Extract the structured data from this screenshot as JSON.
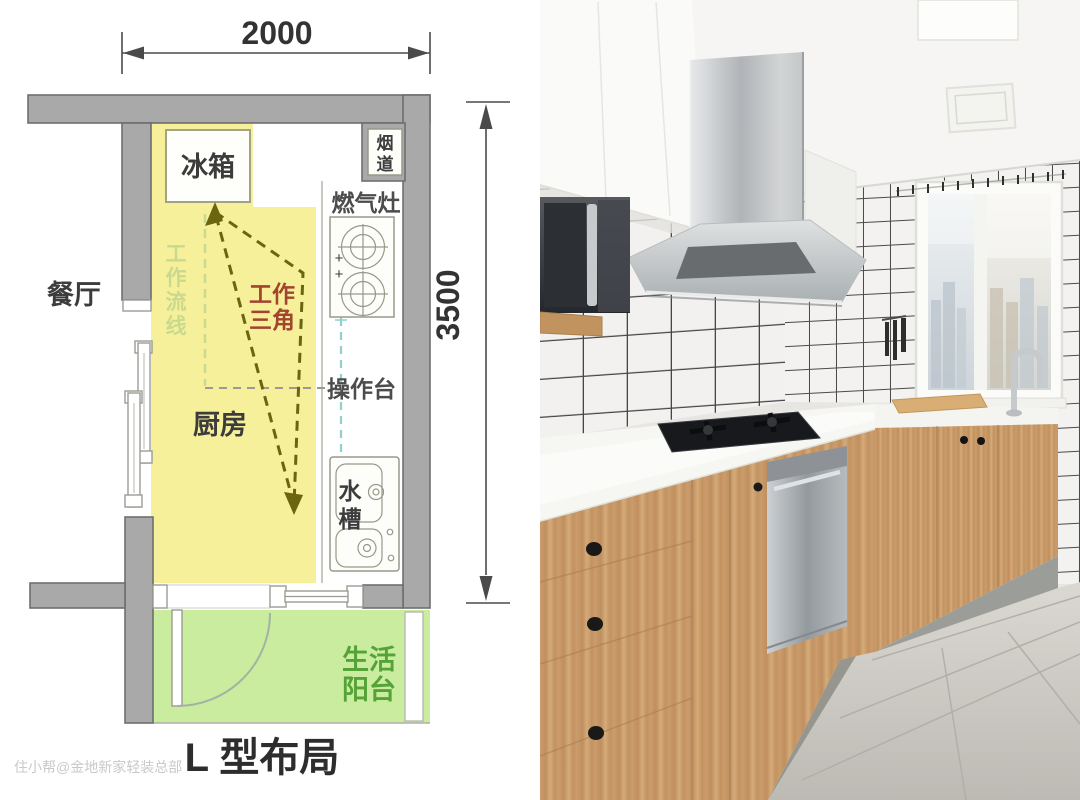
{
  "plan": {
    "dims": {
      "width": "2000",
      "height": "3500"
    },
    "labels": {
      "dining": "餐厅",
      "kitchen": "厨房",
      "fridge": "冰箱",
      "flue": [
        "烟",
        "道"
      ],
      "stove": "燃气灶",
      "counter": "操作台",
      "sink": [
        "水",
        "槽"
      ],
      "balcony": [
        "生活",
        "阳台"
      ],
      "triangle": [
        "工作",
        "三角"
      ],
      "flow": [
        "工",
        "作",
        "流",
        "线"
      ],
      "plus": [
        "+",
        "+"
      ]
    },
    "caption": "L 型布局",
    "watermark": "住小帮@金地新家轻装总部"
  },
  "colors": {
    "kitchen_fill": "#f7f09b",
    "balcony_fill": "#c9ec9f",
    "wall_fill": "#a9a9a9",
    "wall_stroke": "#6f6f6f",
    "fixture_stroke": "#98988a",
    "triangle_color": "#6b6410",
    "triangle_label": "#a2442e",
    "flow_line": "#c9d98e",
    "flow_route": "#8ed1cd",
    "balcony_label": "#55a338",
    "text_dark": "#3c3c3c",
    "dim_color": "#4a4a4a",
    "watermark_color": "#c9c9c9"
  }
}
